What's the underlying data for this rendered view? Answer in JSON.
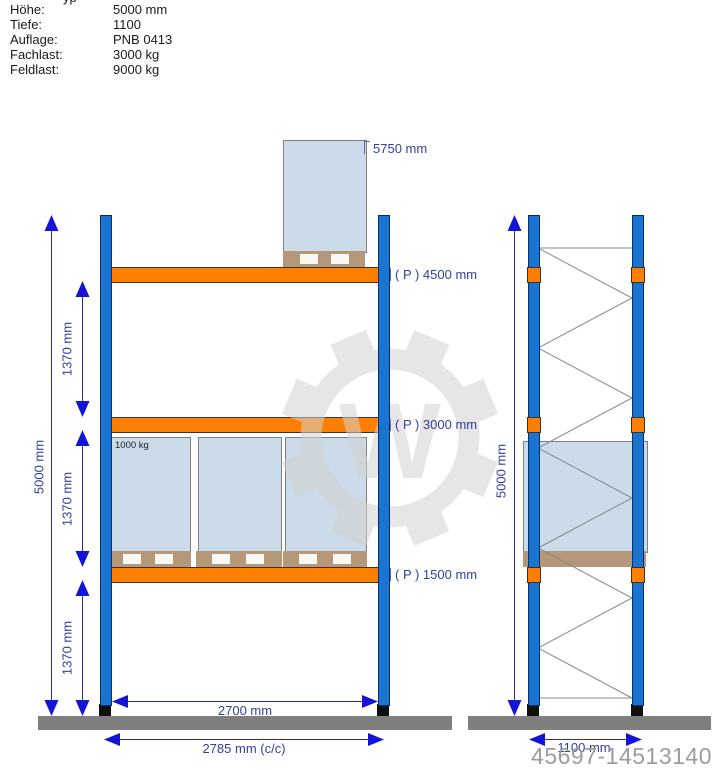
{
  "spec": {
    "fragment": "yp",
    "rows": [
      {
        "label": "Höhe:",
        "value": "5000 mm"
      },
      {
        "label": "Tiefe:",
        "value": "1100"
      },
      {
        "label": "Auflage:",
        "value": "PNB 0413"
      },
      {
        "label": "Fachlast:",
        "value": "3000 kg"
      },
      {
        "label": "Feldlast:",
        "value": "9000 kg"
      }
    ]
  },
  "front_view": {
    "total_height_label": "5000 mm",
    "level_spacing_labels": [
      "1370 mm",
      "1370 mm",
      "1370 mm"
    ],
    "beam_labels": [
      "( P ) 4500 mm",
      "( P ) 3000 mm",
      "( P ) 1500 mm"
    ],
    "top_load_height_label": "5750 mm",
    "pallet_load_label": "1000 kg",
    "clear_width_label": "2700 mm",
    "center_width_label": "2785 mm (c/c)"
  },
  "side_view": {
    "total_height_label": "5000 mm",
    "depth_label": "1100 mm"
  },
  "watermark": {
    "id_number": "45697-14513140",
    "gear_letter": "W"
  },
  "colors": {
    "upright_blue": "#1a75d2",
    "beam_orange": "#ff8000",
    "pallet_tan": "#b49879",
    "load_box_blue": "#cbdbea",
    "floor_gray": "#7f7f7f",
    "dimension_navy": "#323f9f",
    "arrow_blue": "#1414d6",
    "bracing_gray": "#8a8a8a",
    "watermark_gray": "#d2d2d2",
    "id_gray": "#9c9c9c"
  }
}
